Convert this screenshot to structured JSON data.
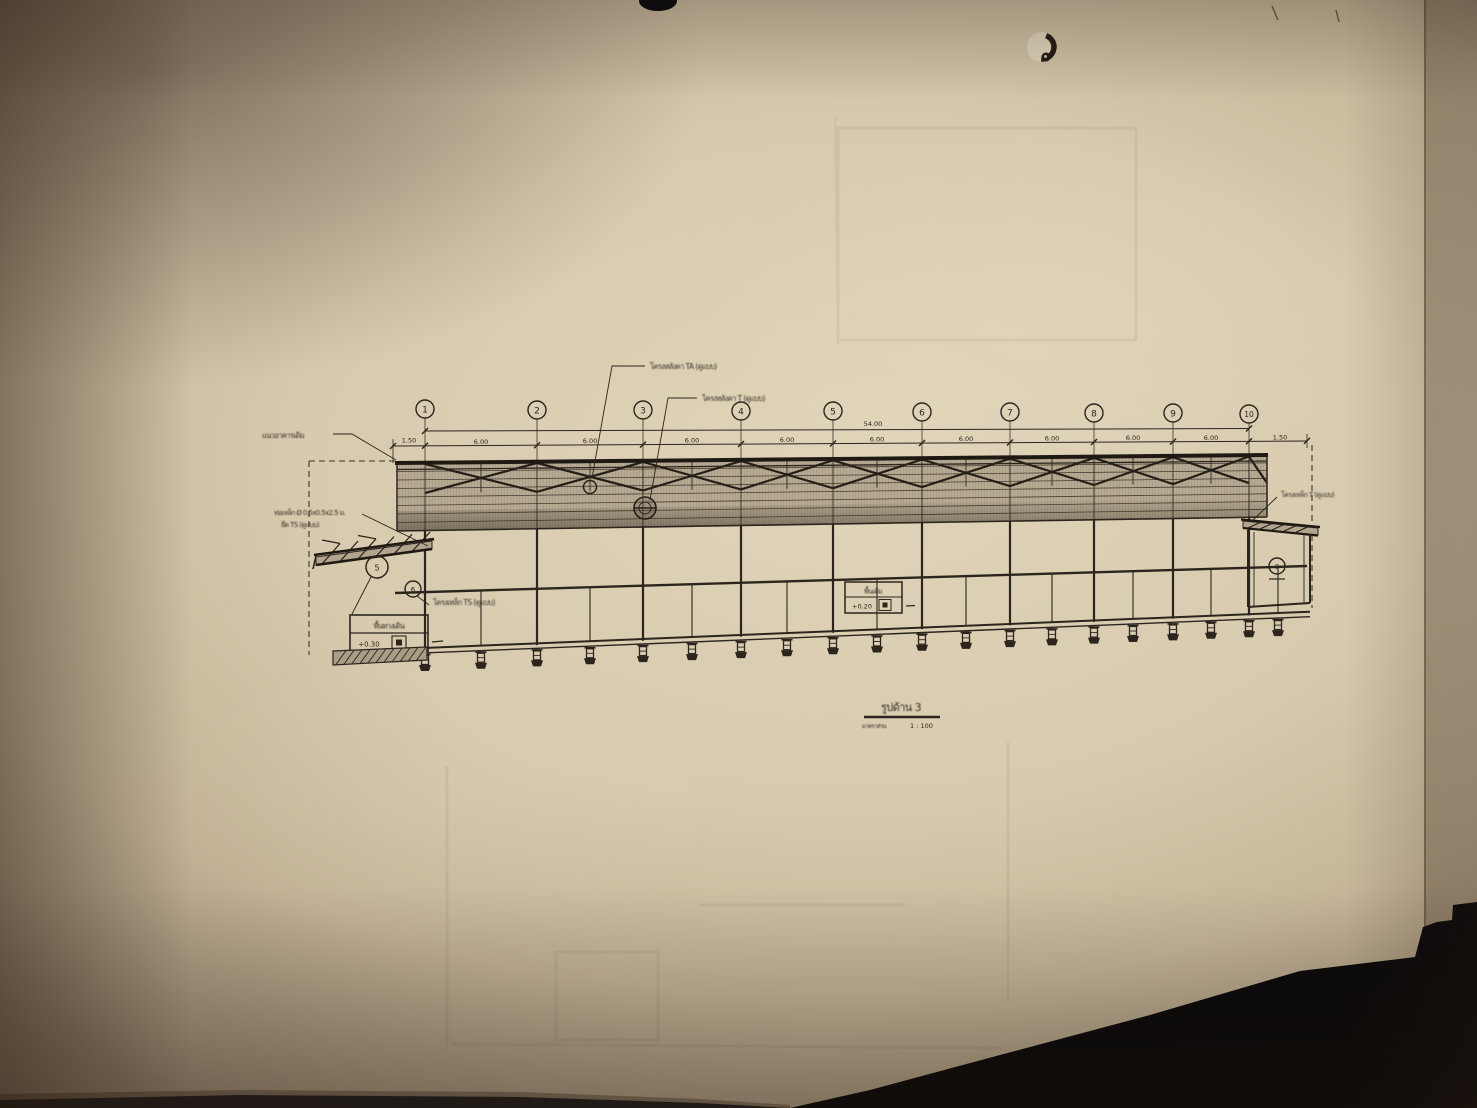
{
  "drawing": {
    "grid_labels": [
      "1",
      "2",
      "3",
      "4",
      "5",
      "6",
      "7",
      "8",
      "9",
      "10"
    ],
    "dims": {
      "total": "54.00",
      "bay": "6.00",
      "left_overhang": "1.50",
      "right_overhang": "1.50"
    },
    "labels": {
      "roof_truss_ta": "โครงหลังคา TA (ดูแบบ)",
      "roof_truss_t": "โครงหลังคา T (ดูแบบ)",
      "existing_building_line": "แนวอาคารเดิม",
      "steel_pipe_1": "ท่อเหล็ก Ø 0.5x0.5x2.5 ม.",
      "steel_pipe_2": "ยึด TS (ดูแบบ)",
      "truss_ts": "โครงเหล็ก TS (ดูแบบ)",
      "truss_t_right": "โครงเหล็ก T (ดูแบบ)"
    },
    "markers": {
      "canopy_left": "5",
      "under_band": "6",
      "right_box": "8"
    },
    "level_boxes": {
      "walkway": {
        "name": "พื้นทางเดิน",
        "level": "+0.30"
      },
      "existing": {
        "name": "พื้นเดิม",
        "level": "+0.20"
      }
    },
    "title": {
      "text": "รูปด้าน 3",
      "scale_label": "มาตราส่วน",
      "scale_value": "1 : 100"
    }
  }
}
